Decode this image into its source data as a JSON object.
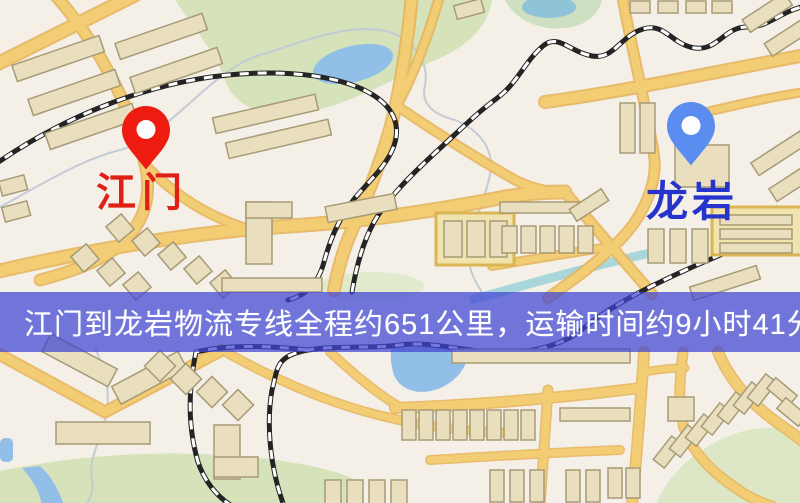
{
  "page": {
    "width": 800,
    "height": 503,
    "kind": "logistics-route-map"
  },
  "map": {
    "markers": [
      {
        "name": "江门",
        "role": "origin",
        "pin_color": "#ee1c10",
        "label_color": "#e02015"
      },
      {
        "name": "龙岩",
        "role": "destination",
        "pin_color": "#5b8cf0",
        "label_color": "#2634cb"
      }
    ],
    "palette": {
      "background": "#f4f0e8",
      "road": "#f2cd74",
      "road_edge": "#e6b257",
      "park": "#d5e2ba",
      "water": "#92bfe8",
      "pond_teal": "#8fc3d8",
      "building": "#e9dfbe",
      "building_outline": "#a79a76",
      "railway": "#242424",
      "highlight_block": "#f0e3ae"
    }
  },
  "banner": {
    "text": "江门到龙岩物流专线全程约651公里，运输时间约9小时41分钟.",
    "background": "#3e44d2",
    "text_color": "#ffffff"
  },
  "route": {
    "origin": "江门",
    "destination": "龙岩",
    "distance": "651公里",
    "duration": "9小时41分钟"
  }
}
